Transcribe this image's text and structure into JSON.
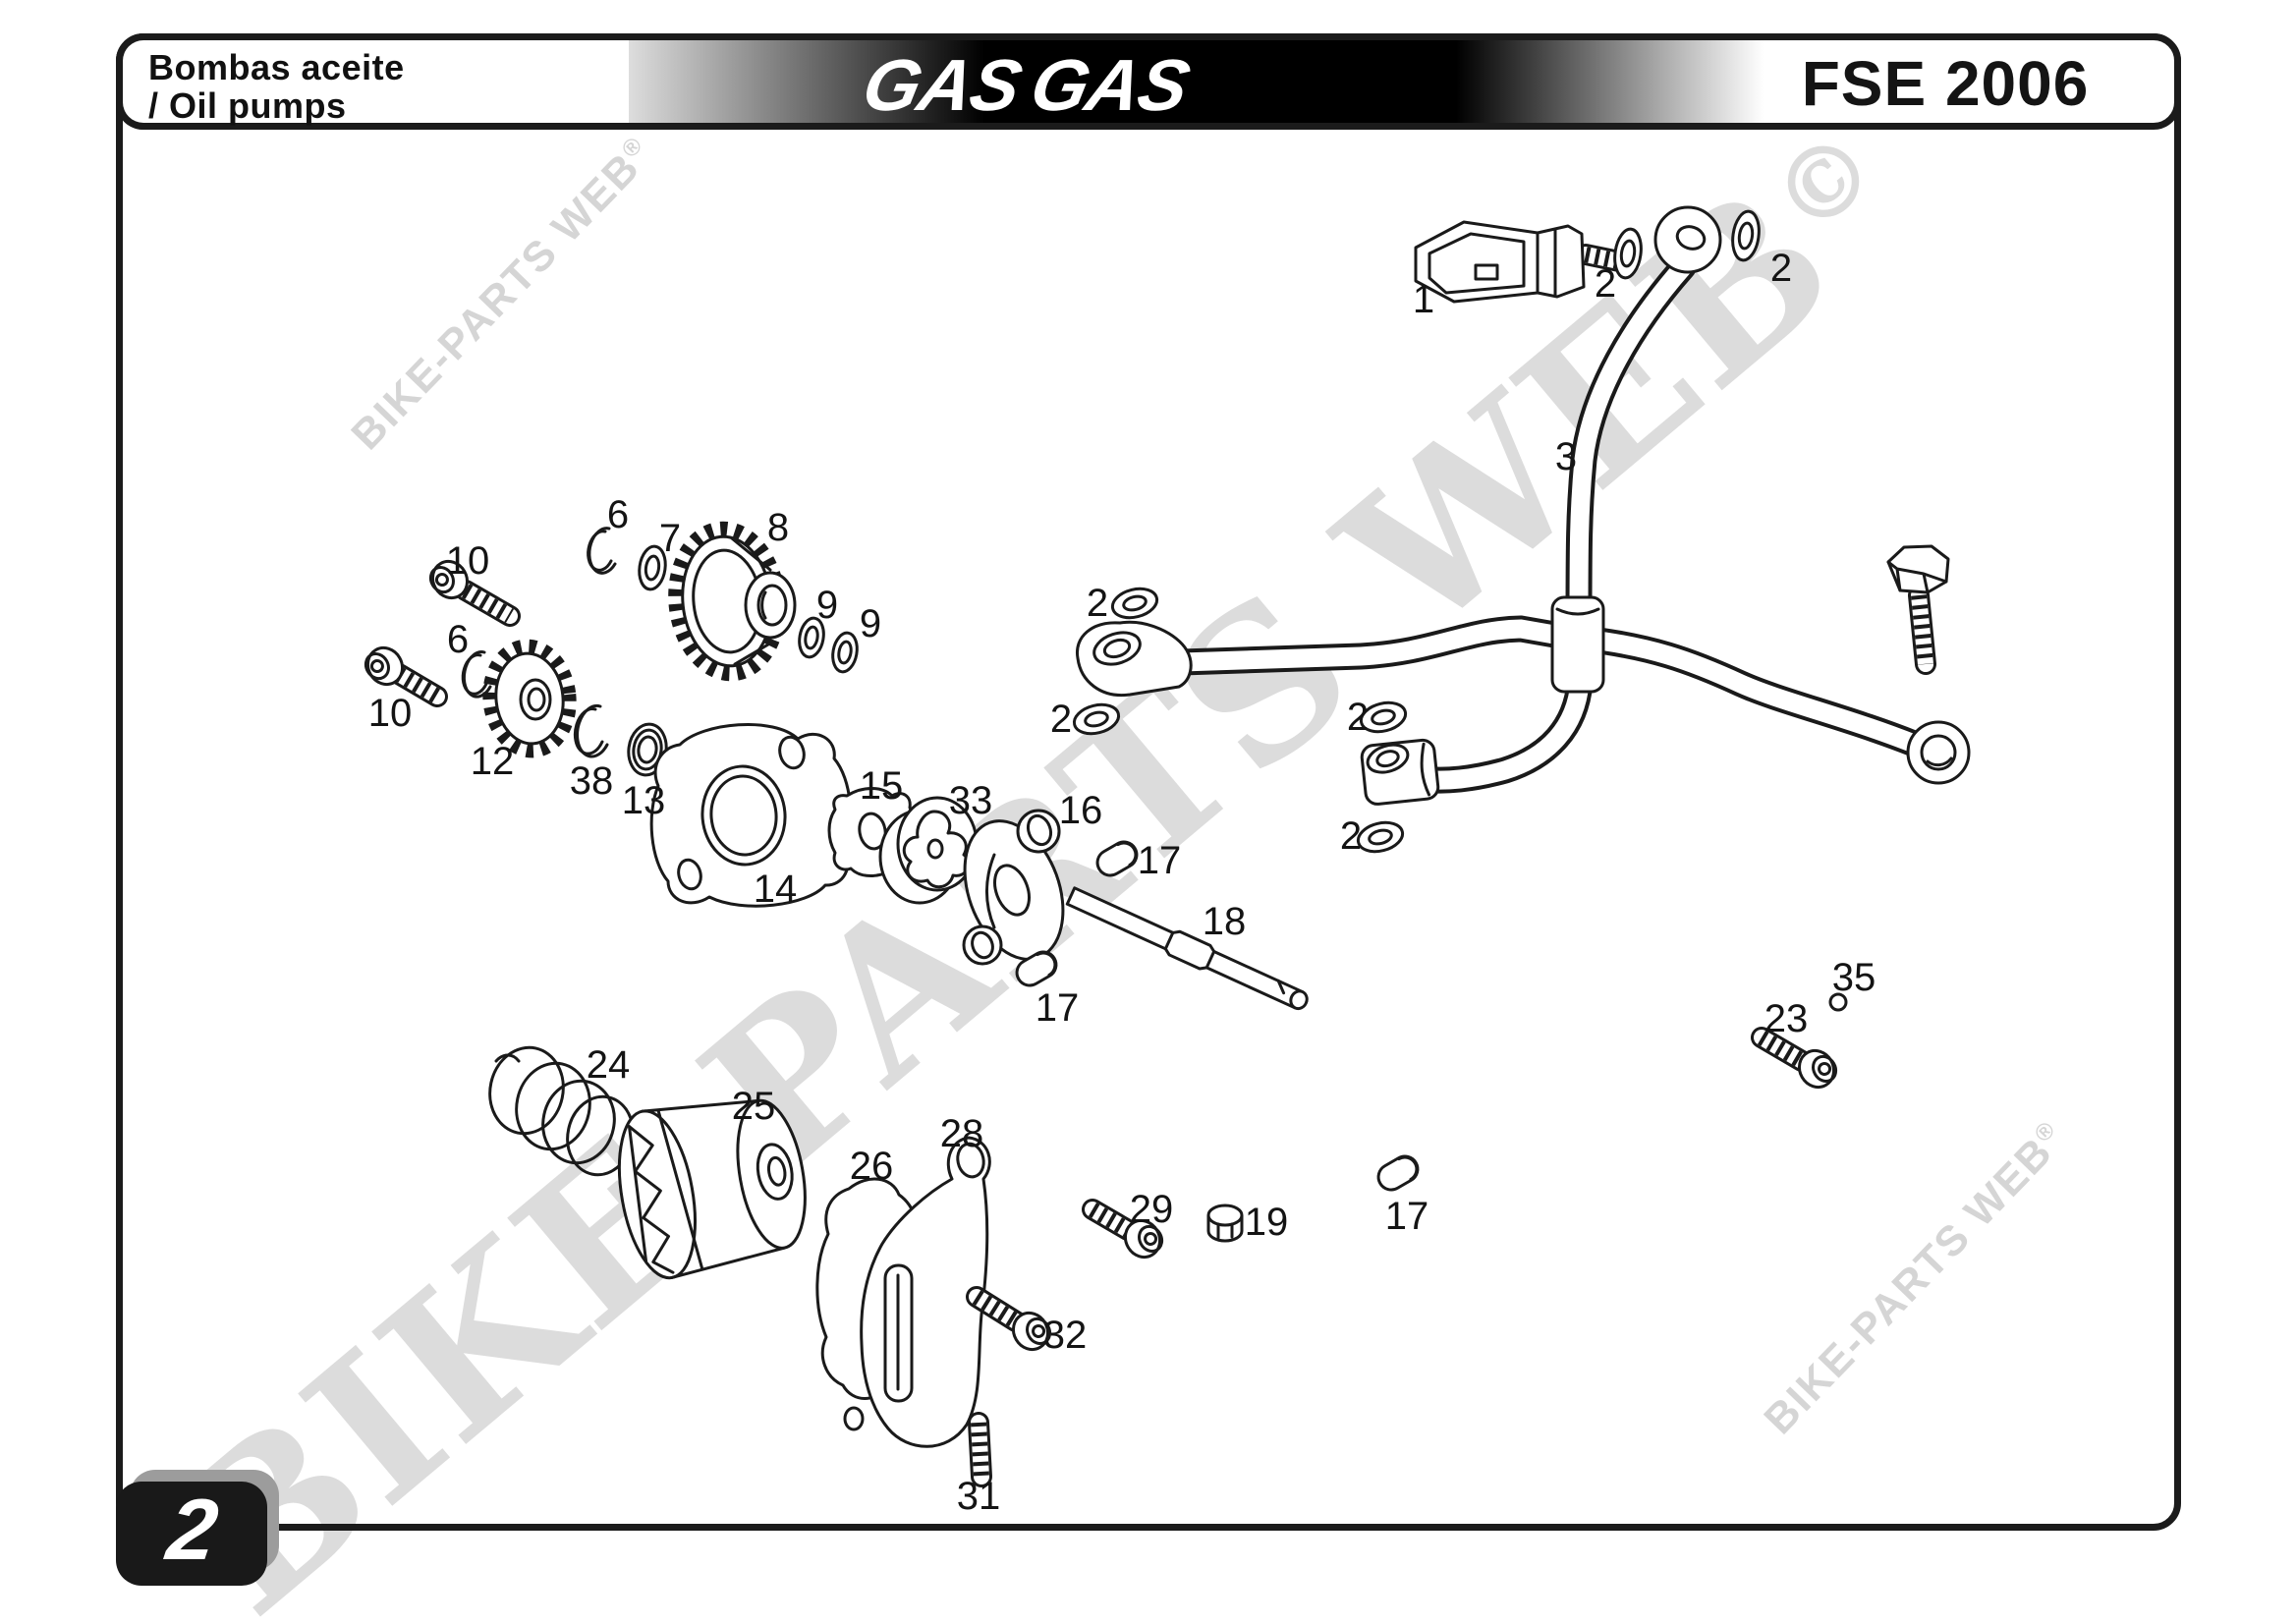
{
  "header": {
    "title_line1": "Bombas aceite",
    "title_line2": "/ Oil pumps",
    "brand": "GAS GAS",
    "model": "FSE 2006"
  },
  "page": {
    "number": "2"
  },
  "watermark": {
    "small_text": "BIKE-PARTS WEB",
    "small_mark": "®",
    "big_text": "BIKE-PARTS WEB",
    "big_mark": "©"
  },
  "callouts": [
    "1",
    "2",
    "2",
    "3",
    "6",
    "7",
    "8",
    "9",
    "9",
    "10",
    "6",
    "10",
    "12",
    "38",
    "13",
    "14",
    "15",
    "33",
    "16",
    "17",
    "17",
    "18",
    "2",
    "2",
    "2",
    "2",
    "24",
    "25",
    "26",
    "28",
    "29",
    "19",
    "17",
    "32",
    "31",
    "23",
    "35"
  ],
  "colors": {
    "ink": "#1a1a1a",
    "watermark_gray": "#d8d8d8",
    "header_black": "#000000",
    "page_box_black": "#191919",
    "page_box_shadow": "#9c9c9c"
  }
}
